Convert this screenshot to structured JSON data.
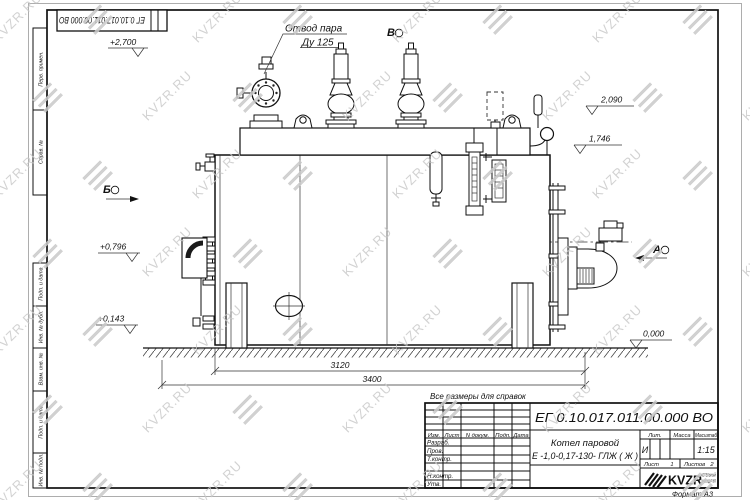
{
  "watermark": {
    "text": "KVZR.RU",
    "color": "#c7c7c7"
  },
  "top_stamp": {
    "doc_number": "ЕГ 0.10.017.011.00.000  ВО"
  },
  "margin_labels": {
    "perv": "Перв. примен.",
    "sprav": "Справ. №",
    "podp1": "Подп. и дата",
    "inv_dubl": "Инв. № дубл.",
    "vzam": "Взам. инв. №",
    "podp2": "Подп. и дата",
    "inv_podl": "Инв. № подл."
  },
  "drawing": {
    "callout": {
      "line1": "Отвод пара",
      "line2": "Ду 125"
    },
    "views": {
      "a": "А",
      "b": "Б",
      "v": "В"
    },
    "elevations": {
      "top": "+2,700",
      "v2090": "2,090",
      "v1746": "1,746",
      "v0796": "+0,796",
      "v0143": "+0,143",
      "zero": "0,000"
    },
    "dimensions": {
      "inner": "3120",
      "overall": "3400"
    }
  },
  "note": "Все размеры для справок",
  "title_block": {
    "doc_number": "ЕГ 0.10.017.011.00.000  ВО",
    "columns": {
      "izm": "Изм.",
      "list": "Лист",
      "ndoc": "N докум.",
      "podp": "Подп.",
      "data": "Дата"
    },
    "rows": {
      "razrab": "Разраб.",
      "prov": "Пров.",
      "tkontr": "Т.контр.",
      "nkontr": "Н.контр.",
      "utv": "Утв."
    },
    "product": {
      "line1": "Котел паровой",
      "line2": "Е -1,0-0,17-130- ГЛЖ ( Ж )"
    },
    "lit": {
      "header": "Лит.",
      "value": "И"
    },
    "mass": {
      "header": "Масса"
    },
    "scale": {
      "header": "Масштаб",
      "value": "1:15"
    },
    "sheet": {
      "label": "Лист",
      "value": "1"
    },
    "sheets": {
      "label": "Листов",
      "value": "2"
    },
    "brand": {
      "name": "KVZR",
      "sub1": "КОТЕЛЬНЫЙ",
      "sub2": "ЗАВОД РЭП"
    },
    "format": "Формат А3"
  }
}
